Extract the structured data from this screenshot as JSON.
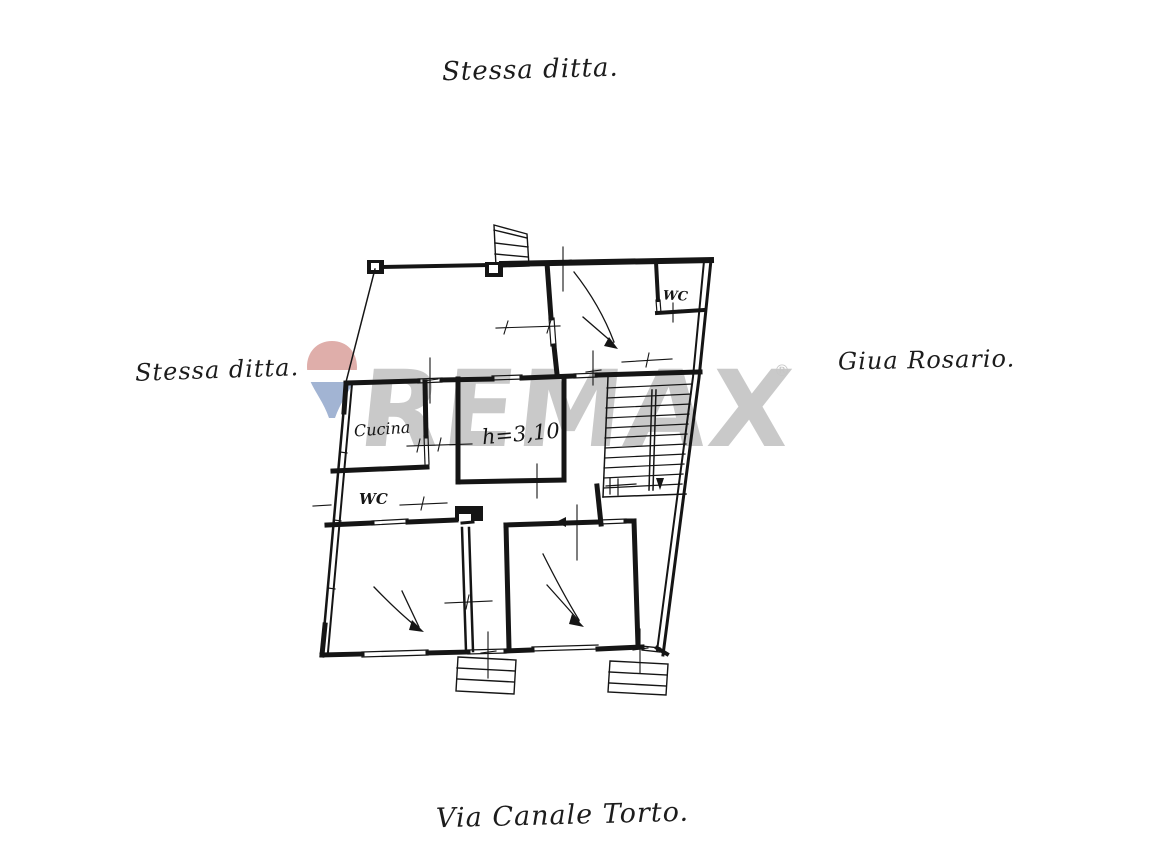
{
  "page": {
    "background": "#ffffff",
    "ink": "#151515"
  },
  "annotations": {
    "top": "Stessa ditta.",
    "left": "Stessa ditta.",
    "right": "Giua Rosario.",
    "bottom": "Via Canale Torto."
  },
  "plan": {
    "labels": {
      "kitchen": "Cucina",
      "wc_left": "WC",
      "wc_top_right": "WC",
      "ceiling_height": "h=3,10"
    }
  },
  "watermark": {
    "brand": "REMAX",
    "registered_mark": "®",
    "text_color": "#c9c9c9",
    "balloon_red": "#d89a96",
    "balloon_white": "#ffffff",
    "balloon_blue": "#8ba2c9"
  }
}
